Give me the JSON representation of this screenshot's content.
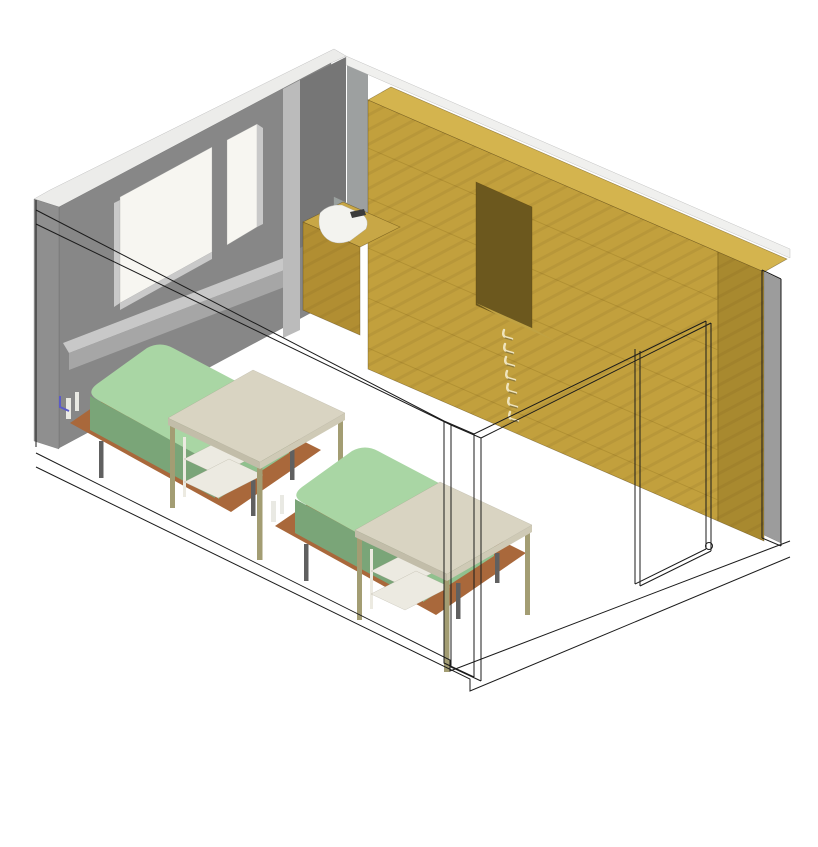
{
  "scene": {
    "view": "axonometric-room-render",
    "objects": [
      "window-wall",
      "window-large-pane",
      "window-small-pane",
      "window-sill-ledge",
      "wall-end-cap",
      "ceiling-edge",
      "wood-wardrobe-wall",
      "wall-niche",
      "niche-shelf",
      "coat-hooks",
      "sink-counter",
      "sink-basin",
      "sink-faucet",
      "mirror-panel",
      "right-wall-strip",
      "door-opening-wireframe",
      "door-knob",
      "bed-1",
      "bed-2",
      "table-1",
      "table-2",
      "cut-wall-wireframe",
      "partition-wireframe",
      "floor-outline",
      "blue-mark"
    ],
    "counts": {
      "beds": 2,
      "tables": 2,
      "hooks": 7,
      "window_panes": 2
    }
  },
  "colors": {
    "background": "#FFFFFF",
    "capWhite": "#ECECEA",
    "ceiling": "#F0F0EE",
    "wallGray": "#878787",
    "wallGrayDark": "#767676",
    "wallGrayLight": "#BBBBBB",
    "wallGrayMid": "#9DA0A0",
    "endCap": "#8F8F8F",
    "glass": "#F7F6F1",
    "frameLight": "#C9C9C9",
    "sillTop": "#C8C8C8",
    "sillFront": "#A6A6A6",
    "rightStrip": "#9C9C9C",
    "woodFront": "#C2A03D",
    "woodTop": "#D4B44E",
    "woodEnd": "#A8892F",
    "plank": "#A07F28",
    "nicheBack": "#6C581E",
    "nicheShelf": "#C0A243",
    "counterFront": "#B18E32",
    "counterTop": "#C8A746",
    "basin": "#F3F3EF",
    "faucet": "#3C3C3C",
    "mirror": "#99A09E",
    "mattressTop": "#A9D6A4",
    "mattressSide": "#7AA578",
    "mattressFoot": "#90C18E",
    "platform": "#A9683B",
    "bedLeg": "#606060",
    "headPost": "#E9E9E3",
    "tableTop": "#D9D4C2",
    "tableEdge": "#C2BDA9",
    "tableEdge2": "#CFCAB6",
    "tableLeg": "#A39D73",
    "shelf": "#ECEAE1",
    "hookLight": "#EFE4BD",
    "hookShadow": "#8C7A3D",
    "wire": "#1B1B1B",
    "blueMark": "#5A5AC8"
  }
}
